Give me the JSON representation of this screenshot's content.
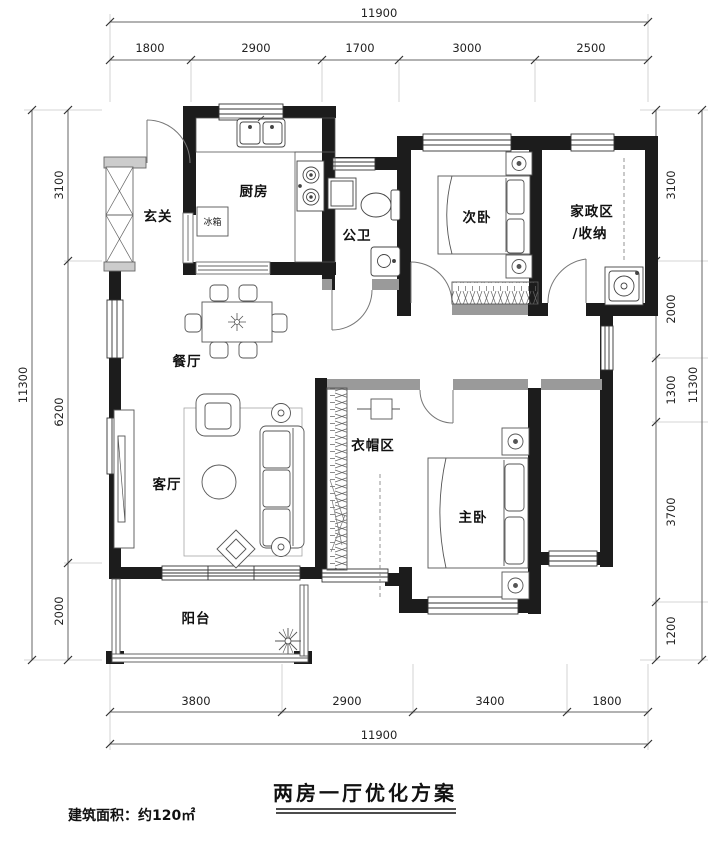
{
  "title_block": {
    "plan_title": "两房一厅优化方案",
    "area_note": "建筑面积：约120㎡"
  },
  "rooms": {
    "entry": "玄关",
    "kitchen": "厨房",
    "fridge": "冰箱",
    "bathroom": "公卫",
    "bedroom2": "次卧",
    "laundry_line1": "家政区",
    "laundry_line2": "/收纳",
    "dining": "餐厅",
    "living": "客厅",
    "cloakroom": "衣帽区",
    "master": "主卧",
    "balcony": "阳台"
  },
  "dimensions": {
    "top": {
      "total": "11900",
      "segments": [
        "1800",
        "2900",
        "1700",
        "3000",
        "2500"
      ]
    },
    "bottom": {
      "total": "11900",
      "segments": [
        "3800",
        "2900",
        "3400",
        "1800"
      ]
    },
    "left": {
      "total": "11300",
      "segments": [
        "3100",
        "6200",
        "2000"
      ]
    },
    "right": {
      "total": "11300",
      "segments": [
        "3100",
        "2000",
        "1300",
        "3700",
        "1200"
      ]
    }
  },
  "colors": {
    "wall": "#1c1c1c",
    "partition": "#9a9a9a",
    "line": "#555555",
    "dim_text": "#222222"
  }
}
